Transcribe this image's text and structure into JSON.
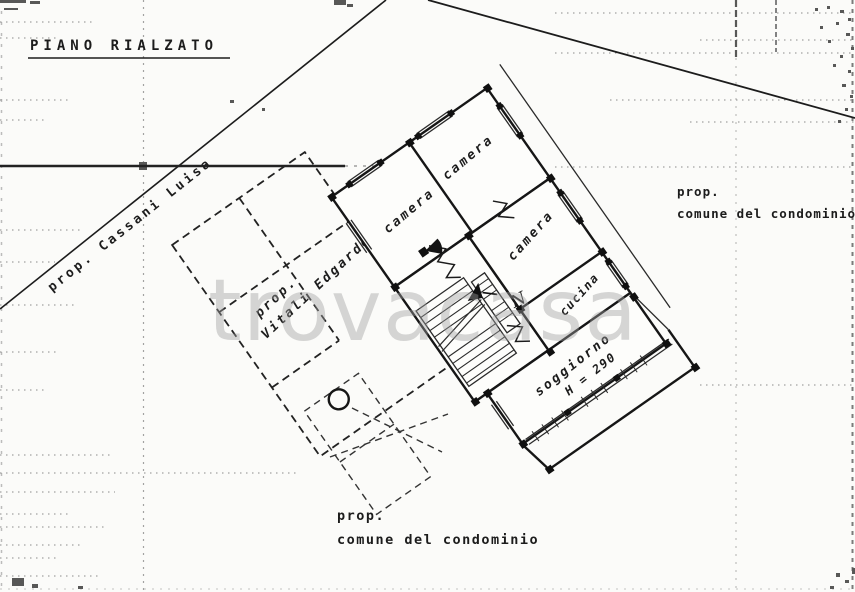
{
  "title": {
    "text": "PIANO RIALZATO"
  },
  "boundaries": {
    "owner_left": "prop. Cassani Luisa",
    "owner_right": {
      "line1": "prop.",
      "line2": "comune del condominio"
    },
    "owner_bottom": {
      "line1": "prop.",
      "line2": "comune del condominio"
    }
  },
  "apartment_left": {
    "owner_line1": "prop.",
    "owner_line2": "Vitali Edgardo"
  },
  "rooms": {
    "camera1": "camera",
    "camera2": "camera",
    "camera3": "camera",
    "cucina": "cucina",
    "soggiorno": {
      "name": "soggiorno",
      "height": "H = 290"
    }
  },
  "north_indicator": "N",
  "watermark": "trovacasa",
  "colors": {
    "paper": "#fbfbf9",
    "ink": "#161616",
    "watermark": "#9f9f9f"
  }
}
